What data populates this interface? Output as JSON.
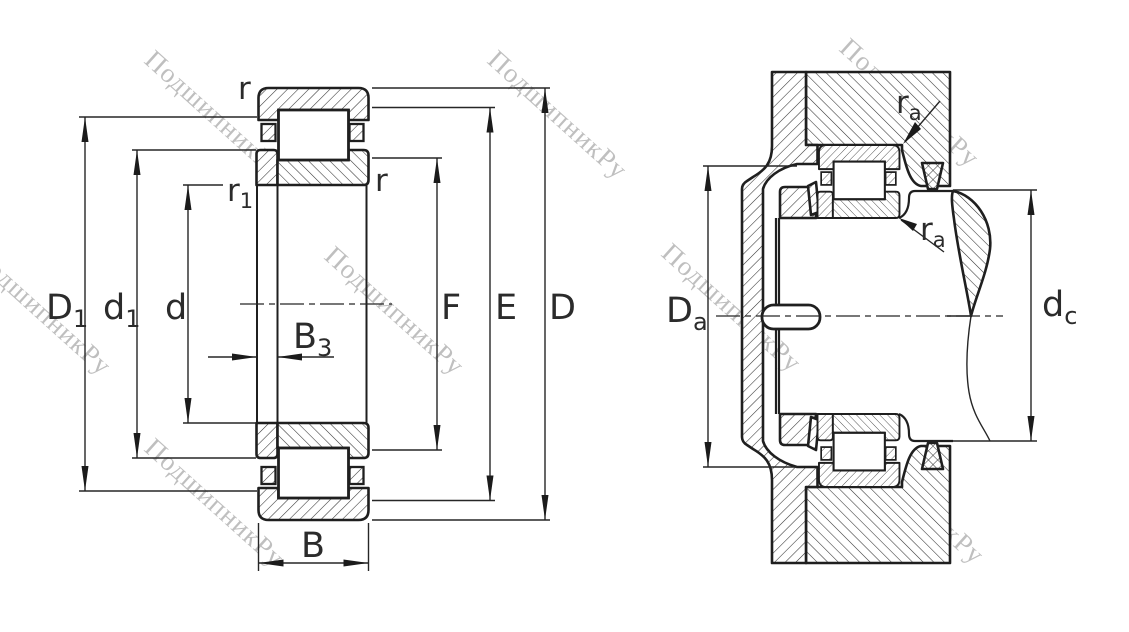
{
  "watermark": {
    "text": "ПодшипникРу",
    "color": "#b9b9b9"
  },
  "left_view": {
    "name": "bearing-cross-section",
    "labels": {
      "r_top": "r",
      "r1": {
        "main": "r",
        "sub": "1"
      },
      "r_right": "r",
      "D1": {
        "main": "D",
        "sub": "1"
      },
      "d1": {
        "main": "d",
        "sub": "1"
      },
      "d": "d",
      "B3": {
        "main": "B",
        "sub": "3"
      },
      "B": "B",
      "F": "F",
      "E": "E",
      "D": "D"
    }
  },
  "right_view": {
    "name": "bearing-mounted-arrangement",
    "labels": {
      "ra_upper": {
        "main": "r",
        "sub": "a"
      },
      "ra_lower": {
        "main": "r",
        "sub": "a"
      },
      "Da": {
        "main": "D",
        "sub": "a"
      },
      "dc": {
        "main": "d",
        "sub": "c"
      }
    }
  },
  "colors": {
    "line": "#262626",
    "background": "#ffffff"
  }
}
